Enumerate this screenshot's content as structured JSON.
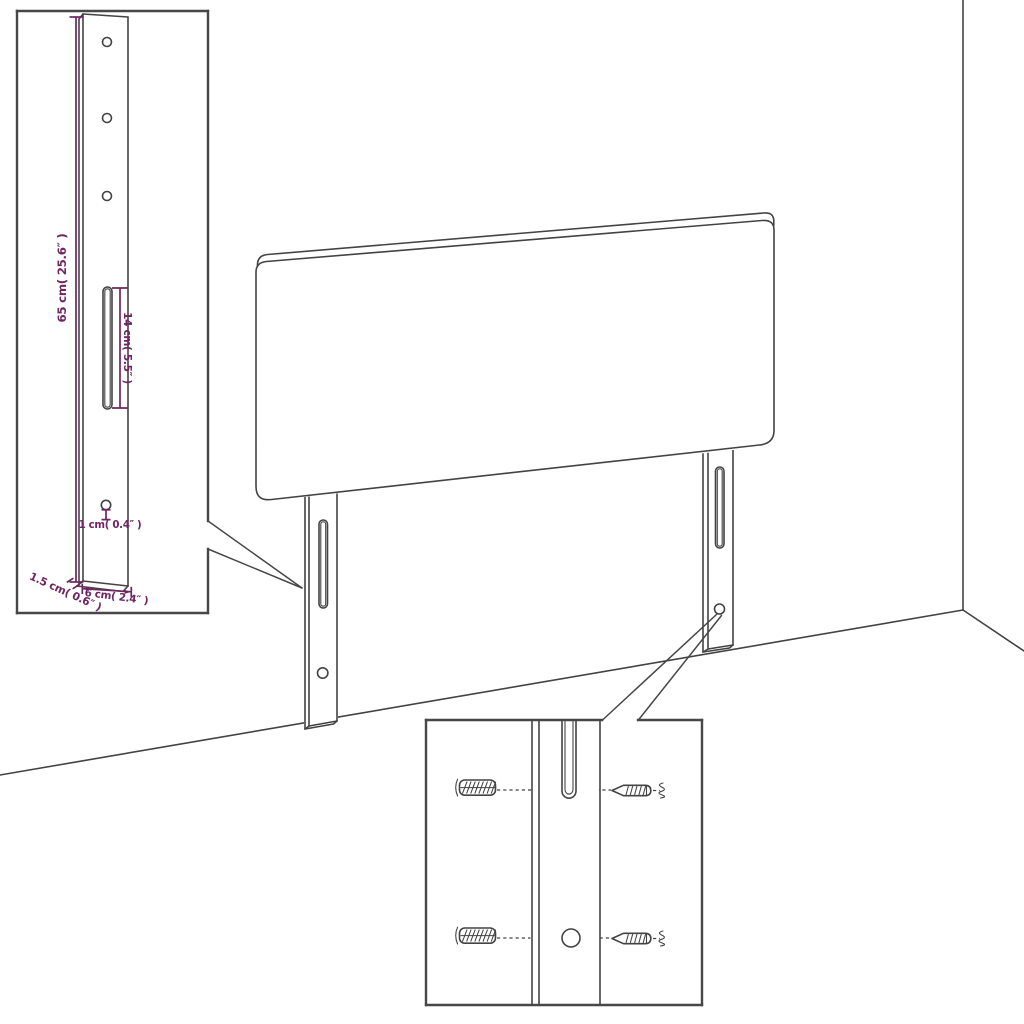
{
  "colors": {
    "background": "#ffffff",
    "line": "#434343",
    "dimension": "#6f2562",
    "inset_border": "#474747"
  },
  "scene": {
    "subject": "headboard with two wall-mount legs shown against a room corner",
    "parts": {
      "headboard_icon": "upholstered-headboard",
      "leg_icon": "mounting-leg-with-slot",
      "wall_plug_icon": "wall-plug",
      "screw_icon": "screw",
      "zigzag_icon": "wall-break-squiggle"
    }
  },
  "leg_detail_inset": {
    "name": "leg dimension detail",
    "dimensions": {
      "leg_height": "65 cm( 25.6″ )",
      "slot_length": "14 cm( 5.5″ )",
      "hole_diameter": "1 cm( 0.4″ )",
      "leg_thickness": "1.5 cm( 0.6″ )",
      "leg_width": "6 cm( 2.4″ )"
    }
  },
  "mount_detail_inset": {
    "name": "wall mounting hardware detail"
  }
}
